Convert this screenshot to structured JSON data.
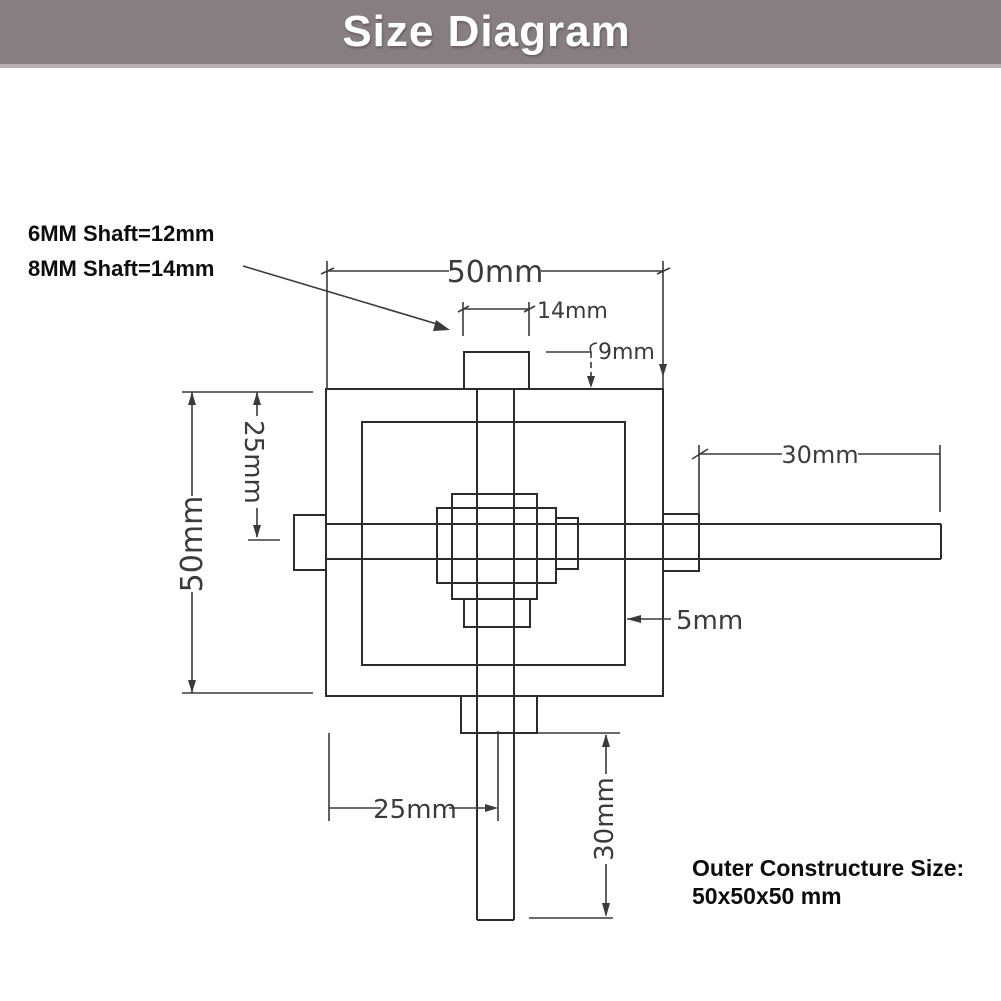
{
  "header": {
    "title": "Size Diagram",
    "bg_color": "#867e81",
    "text_color": "#ffffff"
  },
  "annotations": {
    "shaft_note_line1": "6MM Shaft=12mm",
    "shaft_note_line2": "8MM Shaft=14mm",
    "outer_size_line1": "Outer Constructure Size:",
    "outer_size_line2": "50x50x50 mm"
  },
  "dimensions": {
    "top_width": "50mm",
    "top_shaft_width": "14mm",
    "top_collar_height": "9mm",
    "left_height": "50mm",
    "left_upper": "25mm",
    "right_shaft_length": "30mm",
    "wall_thickness": "5mm",
    "bottom_offset": "25mm",
    "bottom_shaft_length": "30mm"
  },
  "diagram": {
    "line_color": "#2c2c2c",
    "dim_color": "#3a3a3a"
  }
}
